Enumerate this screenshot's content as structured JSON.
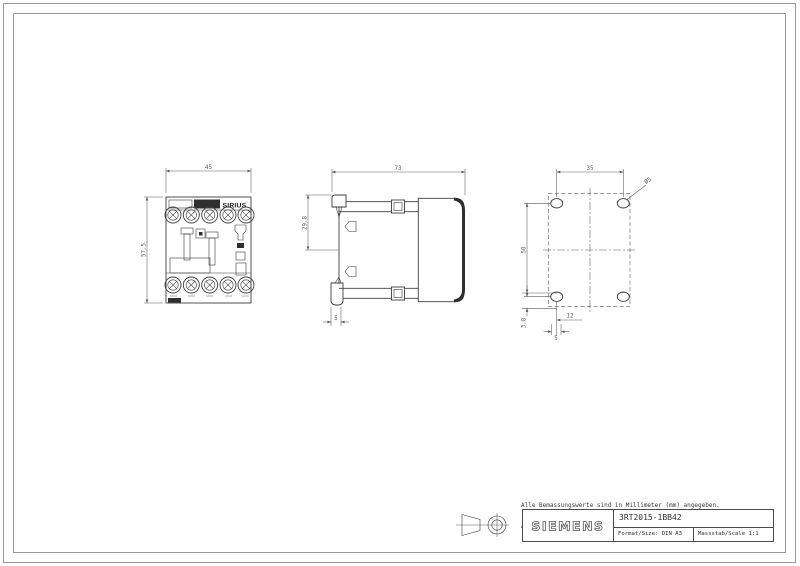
{
  "views": {
    "front": {
      "width_dim": "45",
      "height_dim": "57.5",
      "brand_label": "SIRIUS"
    },
    "side": {
      "width_dim": "73",
      "clip_dim": "29.8",
      "foot_dim": "5"
    },
    "drill": {
      "h_spacing": "35",
      "v_spacing": "50",
      "hole_dia": "Ø5",
      "edge_offset": "3.8",
      "offset_x": "12",
      "offset_y": "5"
    }
  },
  "notes": {
    "de": "Alle Bemassungswerte sind in Millimeter (mm) angegeben.",
    "en": "All dimensions are in millimeters (mm)"
  },
  "titleblock": {
    "brand": "SIEMENS",
    "part_number": "3RT2015-1BB42",
    "format_label": "Format/Size: DIN A3",
    "scale_label": "Massstab/Scale 1:1"
  },
  "colors": {
    "line": "#3d3d3d",
    "dim": "#5a5a5a",
    "frame": "#9a9a9a",
    "dark_fill": "#2f2f2f"
  }
}
